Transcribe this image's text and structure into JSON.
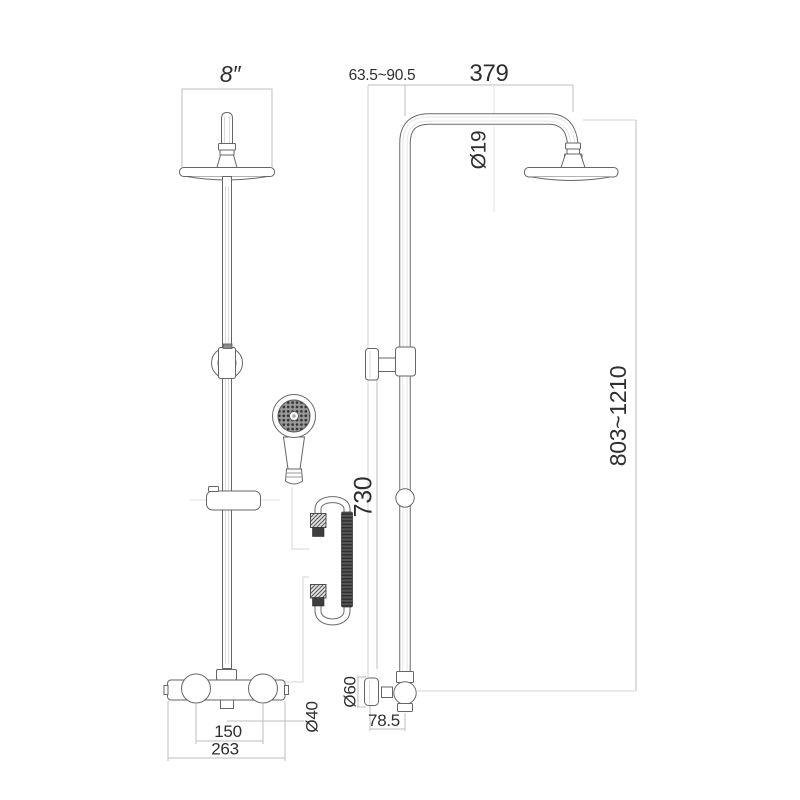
{
  "drawing": {
    "labels": {
      "head_size": "8″",
      "wall_distance": "63.5~90.5",
      "arm_projection": "379",
      "pipe_diameter": "Ø19",
      "adjustable_height": "803~1210",
      "slide_rail_length": "730",
      "side_handle_diameter": "Ø60",
      "valve_projection": "78.5",
      "handle_centres": "150",
      "valve_width": "263",
      "handle_diameter": "Ø40"
    },
    "colors": {
      "background": "#ffffff",
      "line": "#666666",
      "dimension_line": "#bdbdbd",
      "text": "#2f2f2f",
      "hose_dark": "#3e3e3e"
    }
  }
}
